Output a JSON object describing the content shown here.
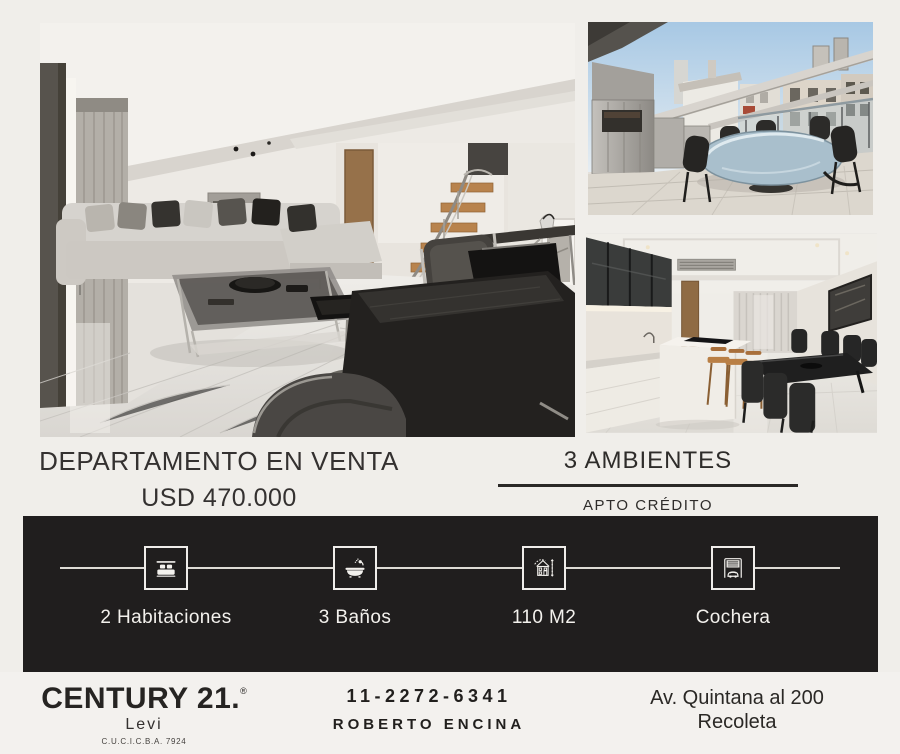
{
  "colors": {
    "page_background": "#f0eeea",
    "feature_bar": "#201e1e",
    "text_dark": "#2e2c2a",
    "icon_white": "#f3f1ed"
  },
  "listing": {
    "title": "DEPARTAMENTO EN VENTA",
    "price": "USD 470.000",
    "rooms": "3 AMBIENTES",
    "credit": "APTO CRÉDITO"
  },
  "photos": [
    {
      "name": "living-room-photo"
    },
    {
      "name": "terrace-photo"
    },
    {
      "name": "kitchen-dining-photo"
    }
  ],
  "features": [
    {
      "icon": "bed-icon",
      "label": "2 Habitaciones"
    },
    {
      "icon": "bathtub-icon",
      "label": "3 Baños"
    },
    {
      "icon": "house-measure-icon",
      "label": "110 M2"
    },
    {
      "icon": "garage-icon",
      "label": "Cochera"
    }
  ],
  "footer": {
    "brand": "CENTURY 21.",
    "registered": "®",
    "office": "Levi",
    "license": "C.U.C.I.C.B.A. 7924",
    "phone": "11-2272-6341",
    "agent": "ROBERTO ENCINA",
    "address_line1": "Av. Quintana al 200",
    "address_line2": "Recoleta"
  }
}
